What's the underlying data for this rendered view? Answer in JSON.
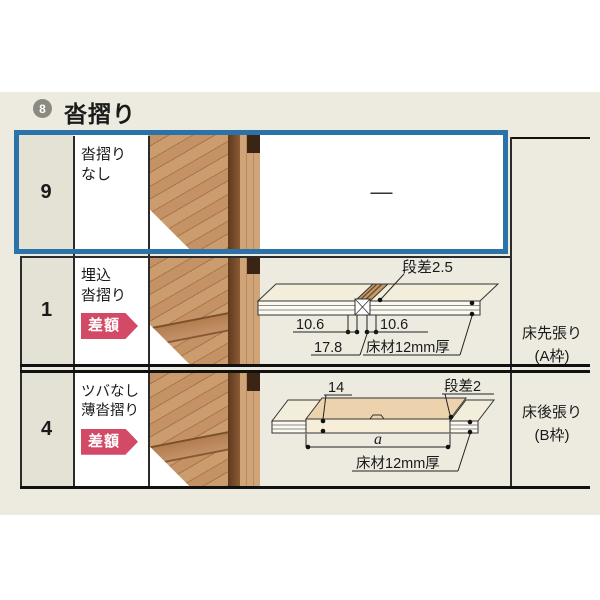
{
  "header": {
    "badge_number": "8",
    "title": "沓摺り"
  },
  "rows": [
    {
      "num": "9",
      "label_line1": "沓摺り",
      "label_line2": "なし",
      "placeholder_dash": "—"
    },
    {
      "num": "1",
      "label_line1": "埋込",
      "label_line2": "沓摺り",
      "badge": "差額"
    },
    {
      "num": "4",
      "label_line1": "ツバなし",
      "label_line2": "薄沓摺り",
      "badge": "差額"
    }
  ],
  "right_column": {
    "a_line1": "床先張り",
    "a_line2": "(A枠)",
    "b_line1": "床後張り",
    "b_line2": "(B枠)"
  },
  "diagram_embedded": {
    "step": "段差2.5",
    "dim_left": "10.6",
    "dim_right": "10.6",
    "dim_total": "17.8",
    "material": "床材12mm厚"
  },
  "diagram_thin": {
    "thickness": "14",
    "step": "段差2",
    "width_label": "a",
    "material": "床材12mm厚"
  },
  "colors": {
    "highlight_blue": "#2a72a8",
    "badge_pink": "#d24a66",
    "panel_beige": "#edeae0",
    "number_cell_beige": "#e4e1d5",
    "header_circle_gray": "#8b8a80"
  }
}
